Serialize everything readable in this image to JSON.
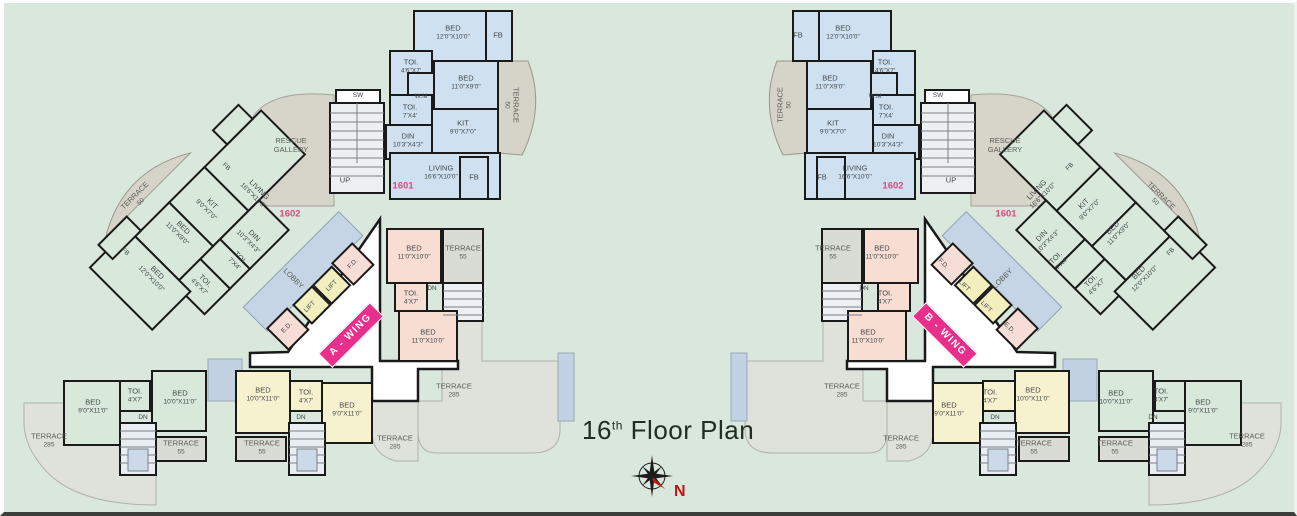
{
  "title": {
    "num": "16",
    "sup": "th",
    "rest": "Floor Plan"
  },
  "compass": {
    "north": "N"
  },
  "banners": {
    "a": "A - WING",
    "b": "B - WING"
  },
  "units": {
    "left_rect": "1601",
    "left_diag": "1602",
    "right_rect": "1602",
    "right_diag": "1601"
  },
  "rooms": {
    "bed": "BED",
    "kit": "KIT",
    "living": "LIVING",
    "din": "DIN",
    "toi": "TOI.",
    "wm": "W.M",
    "fb": "FB",
    "sw": "SW",
    "up": "UP",
    "dn": "DN",
    "lobby": "LOBBY",
    "lift": "LIFT",
    "fd": "F.D.",
    "ed": "E.D.",
    "terrace": "TERRACE",
    "rescue_l1": "RESCUE",
    "rescue_l2": "GALLERY"
  },
  "dims": {
    "d12x10": "12'0\"X10'0\"",
    "d11x9": "11'0\"X9'0\"",
    "d16x10": "16'6\"X10'0\"",
    "d10x4": "10'3\"X4'3\"",
    "d9x7": "9'0\"X7'0\"",
    "d46x7": "4'6\"X7'",
    "d7x4": "7'X4'",
    "d11x10": "11'0\"X10'0\"",
    "d4x7": "4'X7'",
    "d9x11": "9'0\"X11'0\"",
    "d10x11": "10'0\"X11'0\"",
    "t50": "50",
    "t55": "55",
    "t285": "285"
  },
  "palette": {
    "background": "#d9e7dc",
    "unit_blue": "#cfe1f1",
    "unit_green": "#d8e9dc",
    "unit_pink": "#f8ddd3",
    "unit_yellow": "#f6f2cf",
    "lift_yellow": "#f3eebd",
    "door_pink": "#f7ddd5",
    "lobby_blue": "#c5d5e5",
    "terrace_gray": "#dfe2da",
    "banner_magenta": "#e82f8b",
    "unit_number_pink": "#e0487e",
    "north_red": "#c41414",
    "wall": "#1a1a1a"
  }
}
